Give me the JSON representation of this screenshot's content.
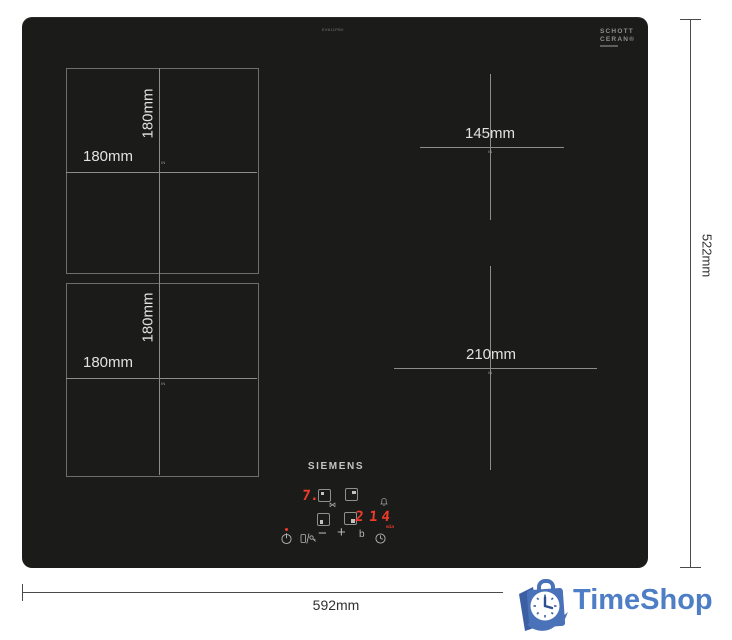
{
  "page": {
    "background": "#ffffff"
  },
  "hob": {
    "surface_color": "#1b1b19",
    "model_text": "EX611PB0",
    "schott_logo": {
      "line1": "SCHOTT",
      "line2": "CERAN®"
    }
  },
  "zones": {
    "back_left": {
      "width_label": "180mm",
      "height_label": "180mm",
      "center_mark": "IN"
    },
    "front_left": {
      "width_label": "180mm",
      "height_label": "180mm",
      "center_mark": "IN"
    },
    "back_right": {
      "diameter_label": "145mm",
      "center_mark": "IN"
    },
    "front_right": {
      "diameter_label": "210mm",
      "center_mark": "IN"
    }
  },
  "control_panel": {
    "brand": "SIEMENS",
    "left_display": "7.",
    "bridge_symbol": "⋈",
    "right_display": "2",
    "timer_display": "14",
    "timer_unit": "min",
    "minus_label": "−",
    "plus_label": "+",
    "boost_label": "b",
    "display_color": "#ef3b2a"
  },
  "dimensions": {
    "width_label": "592mm",
    "height_label": "522mm"
  },
  "watermark": {
    "name": "TimeShop",
    "text_color": "#4d7ec6",
    "icon_blue": "#4a72b8",
    "icon_blue_dark": "#3c5fa4"
  }
}
